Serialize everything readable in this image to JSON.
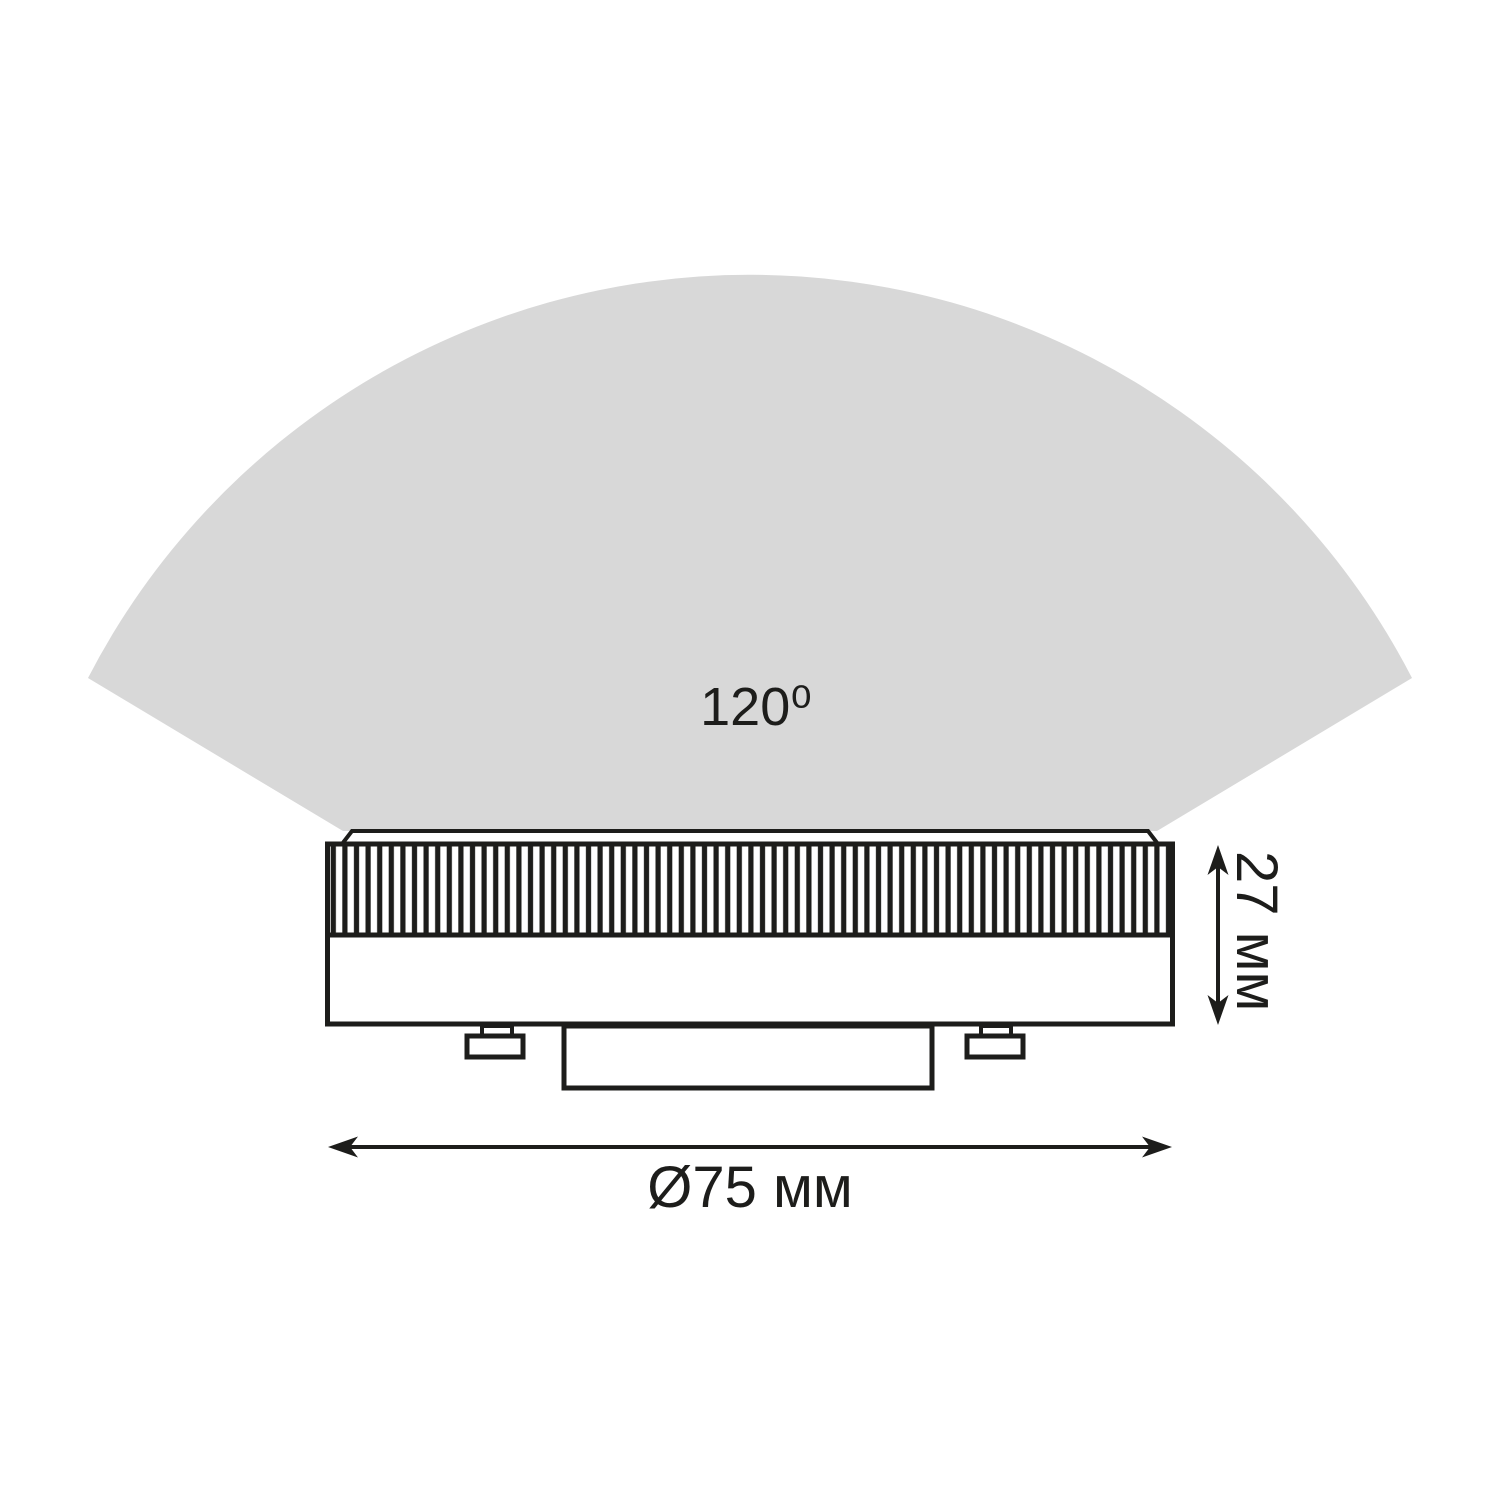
{
  "diagram": {
    "title": "GX53 lamp dimensions diagram",
    "beam_angle_label": "120⁰",
    "height_label": "27 мм",
    "diameter_label": "Ø75 мм",
    "colors": {
      "beam_fill": "#d8d8d8",
      "line": "#1d1d1b",
      "background": "#ffffff"
    }
  }
}
